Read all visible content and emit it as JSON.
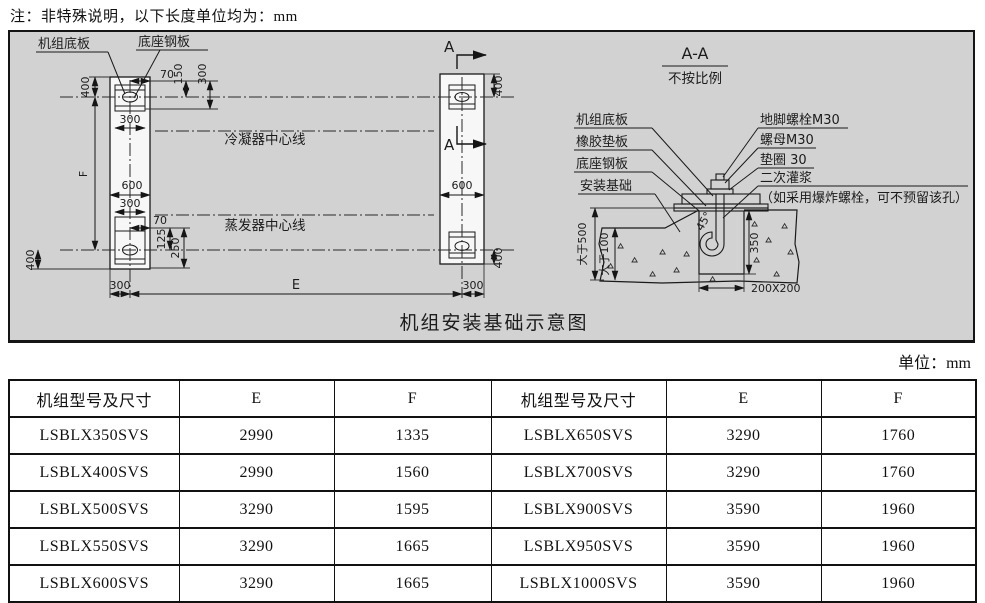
{
  "page": {
    "note": "注：非特殊说明，以下长度单位均为：mm",
    "unit_label": "单位：mm"
  },
  "diagram": {
    "caption": "机组安装基础示意图",
    "plan": {
      "unit_base_plate": "机组底板",
      "base_steel_plate": "底座钢板",
      "condenser_centerline": "冷凝器中心线",
      "evaporator_centerline": "蒸发器中心线",
      "section_marker": "A",
      "dim_400": "400",
      "dim_70": "70",
      "dim_150": "150",
      "dim_300": "300",
      "dim_600": "600",
      "dim_125": "125",
      "dim_250": "250",
      "dim_E": "E",
      "dim_F": "F"
    },
    "section": {
      "title": "A-A",
      "scale_note": "不按比例",
      "unit_base_plate": "机组底板",
      "rubber_pad": "橡胶垫板",
      "base_steel_plate": "底座钢板",
      "foundation": "安装基础",
      "anchor_bolt": "地脚螺栓M30",
      "nut": "螺母M30",
      "washer": "垫圈 30",
      "grouting": "二次灌浆",
      "grouting_note": "（如采用爆炸螺栓，可不预留该孔）",
      "dim_min500": "大于500",
      "dim_min100": "大于100",
      "dim_angle": "45°",
      "dim_350": "350",
      "dim_pocket": "200X200"
    }
  },
  "table": {
    "headers": [
      "机组型号及尺寸",
      "E",
      "F",
      "机组型号及尺寸",
      "E",
      "F"
    ],
    "rows": [
      [
        "LSBLX350SVS",
        "2990",
        "1335",
        "LSBLX650SVS",
        "3290",
        "1760"
      ],
      [
        "LSBLX400SVS",
        "2990",
        "1560",
        "LSBLX700SVS",
        "3290",
        "1760"
      ],
      [
        "LSBLX500SVS",
        "3290",
        "1595",
        "LSBLX900SVS",
        "3590",
        "1960"
      ],
      [
        "LSBLX550SVS",
        "3290",
        "1665",
        "LSBLX950SVS",
        "3590",
        "1960"
      ],
      [
        "LSBLX600SVS",
        "3290",
        "1665",
        "LSBLX1000SVS",
        "3590",
        "1960"
      ]
    ]
  }
}
